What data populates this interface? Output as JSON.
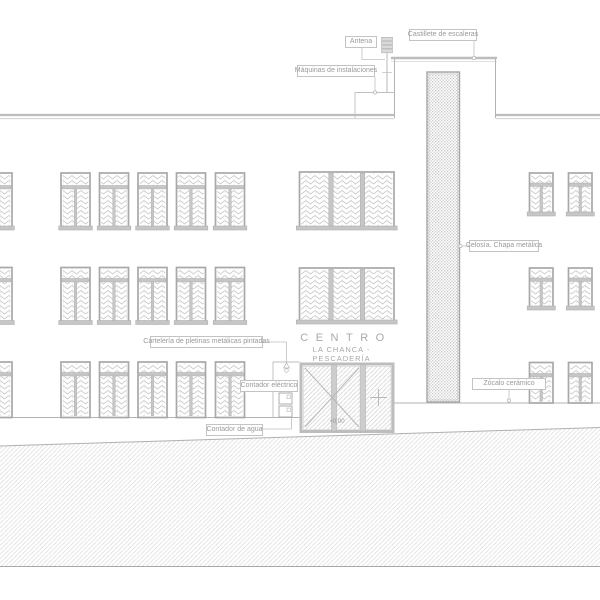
{
  "sign": {
    "line1": "CENTRO",
    "line2": "LA CHANCA - PESCADERÍA"
  },
  "level_marker": "+0.00",
  "callouts": {
    "antena": "Antena",
    "castillete": "Castillete de escaleras",
    "maquinas": "Máquinas de instalaciones",
    "celosia": "Celosía. Chapa metálica",
    "carteleria": "Cartelería de pletinas metálicas pintadas",
    "contador_electrico": "Contador eléctrico",
    "contador_agua": "Contador de agua",
    "zocalo": "Zócalo cerámico"
  },
  "colors": {
    "line": "#b3b3b3",
    "frame": "#a8a8a8",
    "bar_fill": "#c6c6c6",
    "hatch": "#cacaca",
    "text": "#9a9a9a"
  }
}
